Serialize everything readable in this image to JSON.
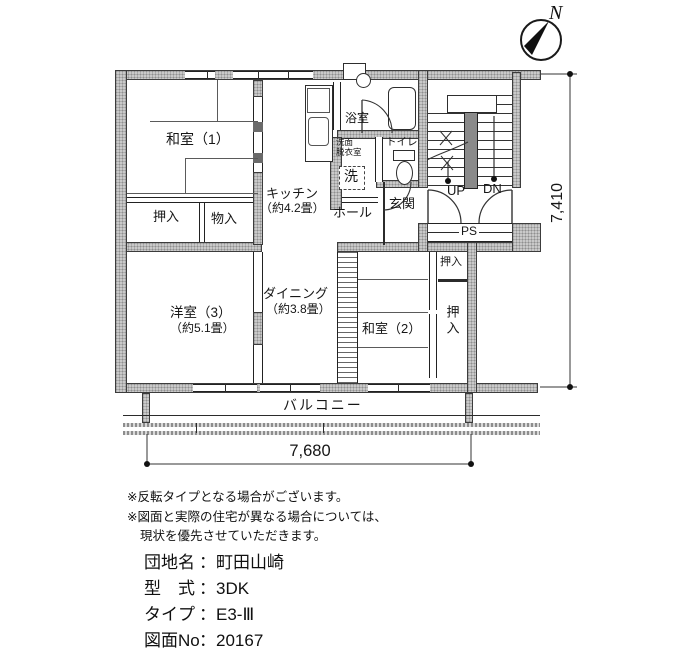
{
  "compass": {
    "north": "N"
  },
  "plan": {
    "rooms": {
      "washitsu1": "和室（1）",
      "oshiire1": "押入",
      "monoire": "物入",
      "kitchen_name": "キッチン",
      "kitchen_size": "（約4.2畳）",
      "bath": "浴室",
      "senmen_line1": "洗面",
      "senmen_line2": "脱衣室",
      "washer": "洗",
      "toilet": "トイレ",
      "hall": "ホール",
      "genkan": "玄関",
      "up": "UP",
      "dn": "DN",
      "ps": "PS",
      "yoshitsu3_name": "洋室（3）",
      "yoshitsu3_size": "（約5.1畳）",
      "dining_name": "ダイニング",
      "dining_size": "（約3.8畳）",
      "washitsu2": "和室（2）",
      "oshiire2": "押入",
      "oshiire3": "押入",
      "balcony": "バルコニー"
    },
    "dimensions": {
      "vertical": "7,410",
      "horizontal": "7,680"
    }
  },
  "notes": {
    "line1": "※反転タイプとなる場合がございます。",
    "line2": "※図面と実際の住宅が異なる場合については、",
    "line3": "現状を優先させていただきます。"
  },
  "info": {
    "colon": "：",
    "rows": [
      {
        "label": "団地名",
        "value": "町田山崎"
      },
      {
        "label": "型　式",
        "value": "3DK"
      },
      {
        "label": "タイプ",
        "value": "E3-Ⅲ"
      },
      {
        "label": "図面No",
        "value": "20167"
      }
    ]
  }
}
